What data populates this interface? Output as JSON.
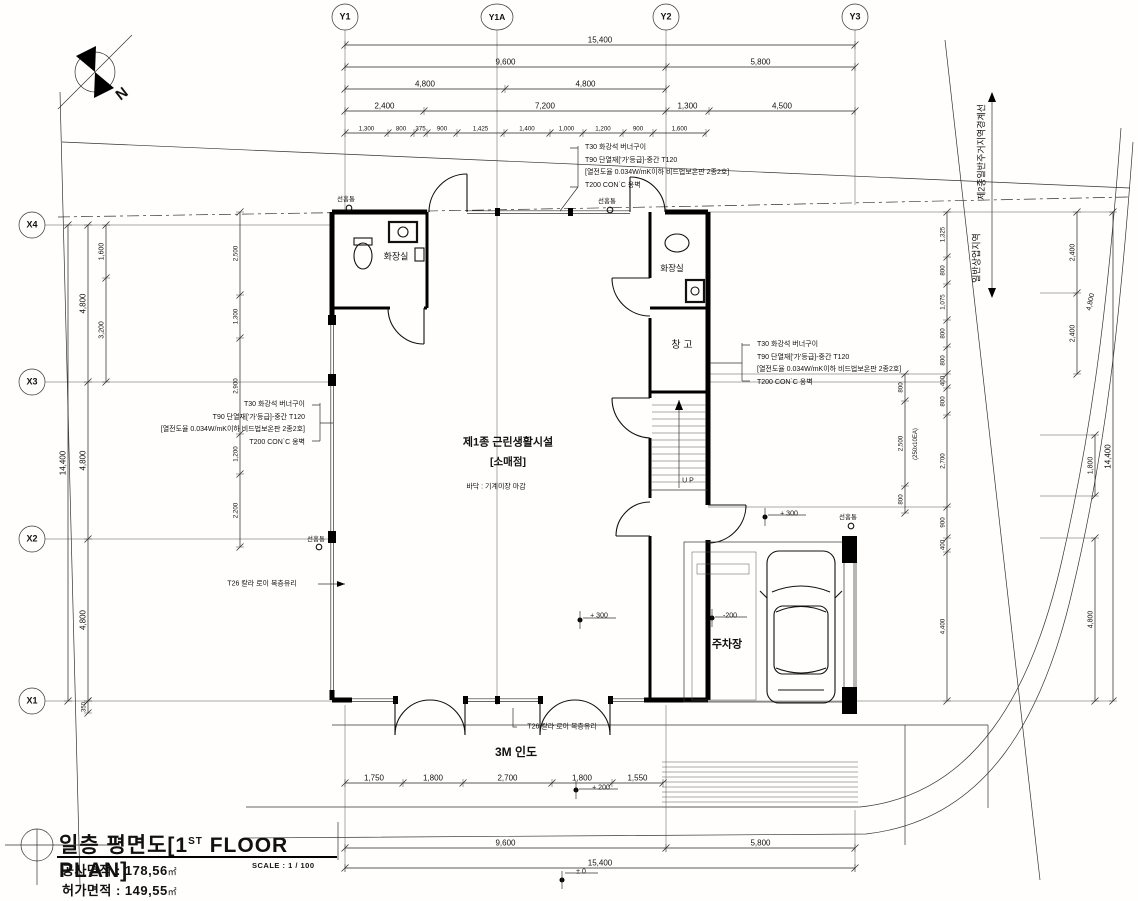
{
  "title_block": {
    "title": "일층 평면도[1",
    "title_sup": "ST",
    "title_tail": " FLOOR PLAN]",
    "area1_label": "공사면적 :",
    "area1_value": "178,56",
    "area1_unit": "㎡",
    "area2_label": "허가면적 :",
    "area2_value": "149,55",
    "area2_unit": "㎡",
    "scale": "SCALE : 1 / 100"
  },
  "notes": {
    "finish_lines": [
      "T30 화강석 버너구이",
      "T90 단열재['가'등급]-중간 T120",
      "[열전도율 0.034W/mK이하 비드법보온판 2종2호]",
      "T200 CON`C 옹벽"
    ],
    "glass_note": "T26 칼라 로이 복층유리",
    "downspout": "선홈통"
  },
  "grid": {
    "y_axes": [
      "Y1",
      "Y1A",
      "Y2",
      "Y3"
    ],
    "x_axes": [
      "X4",
      "X3",
      "X2",
      "X1"
    ]
  },
  "rooms": {
    "main_use": "제1종 근린생활시설",
    "main_use_sub": "[소매점]",
    "floor_finish": "바닥 : 기계미장 마감",
    "restroom": "화장실",
    "storage": "창 고",
    "parking": "주차장",
    "sidewalk": "3M 인도",
    "stair_up": "U P"
  },
  "zones": {
    "boundary": "제2종일반주거지역경계선",
    "commercial": "일반상업지역"
  },
  "levels": [
    "+ 300",
    "+ 300",
    "-200",
    "+ 200",
    "± 0"
  ],
  "dim_chains": [
    {
      "n": "dim-top-row1",
      "o": "h",
      "p": 45,
      "b": [
        345,
        855
      ],
      "v": [
        "15,400"
      ],
      "fs": 8
    },
    {
      "n": "dim-top-row2",
      "o": "h",
      "p": 67,
      "b": [
        345,
        666,
        855
      ],
      "v": [
        "9,600",
        "5,800"
      ],
      "fs": 8
    },
    {
      "n": "dim-top-row3",
      "o": "h",
      "p": 89,
      "b": [
        345,
        505,
        666
      ],
      "v": [
        "4,800",
        "4,800"
      ],
      "fs": 8
    },
    {
      "n": "dim-top-row4",
      "o": "h",
      "p": 111,
      "b": [
        345,
        424,
        666,
        709,
        855
      ],
      "v": [
        "2,400",
        "7,200",
        "1,300",
        "4,500"
      ],
      "fs": 8
    },
    {
      "n": "dim-top-row5",
      "o": "h",
      "p": 133,
      "b": [
        345,
        388,
        414,
        427,
        457,
        504,
        550,
        583,
        623,
        653,
        706
      ],
      "v": [
        "1,300",
        "800",
        "375",
        "900",
        "1,425",
        "1,400",
        "1,000",
        "1,200",
        "900",
        "1,600"
      ],
      "fs": 6.2
    },
    {
      "n": "dim-bottom-row1",
      "o": "h",
      "p": 783,
      "b": [
        345,
        403,
        463,
        552,
        612,
        663
      ],
      "v": [
        "1,750",
        "1,800",
        "2,700",
        "1,800",
        "1,550"
      ],
      "fs": 8
    },
    {
      "n": "dim-bottom-row2",
      "o": "h",
      "p": 848,
      "b": [
        345,
        666,
        855
      ],
      "v": [
        "9,600",
        "5,800"
      ],
      "fs": 8
    },
    {
      "n": "dim-bottom-row3",
      "o": "h",
      "p": 868,
      "b": [
        345,
        855
      ],
      "v": [
        "15,400"
      ],
      "fs": 8
    },
    {
      "n": "dim-left-total",
      "o": "v",
      "p": 68,
      "b": [
        225,
        701
      ],
      "v": [
        "14,400"
      ],
      "fs": 8
    },
    {
      "n": "dim-left-grid",
      "o": "v",
      "p": 88,
      "b": [
        225,
        382,
        539,
        701
      ],
      "v": [
        "4,800",
        "4,800",
        "4,800"
      ],
      "fs": 8
    },
    {
      "n": "dim-left-sub",
      "o": "v",
      "p": 106,
      "b": [
        225,
        278,
        382
      ],
      "v": [
        "1,600",
        "3,200"
      ],
      "fs": 7
    },
    {
      "n": "dim-left-350",
      "o": "v",
      "p": 88,
      "b": [
        701,
        713
      ],
      "v": [
        "350"
      ],
      "fs": 6
    },
    {
      "n": "dim-left-inner",
      "o": "v",
      "p": 240,
      "b": [
        212,
        295,
        338,
        434,
        474,
        547
      ],
      "v": [
        "2,500",
        "1,300",
        "2,900",
        "1,200",
        "2,200"
      ],
      "fs": 6.2
    },
    {
      "n": "dim-right-inner",
      "o": "v",
      "p": 947,
      "b": [
        212,
        257,
        284,
        320,
        347,
        374,
        388,
        415,
        507,
        538,
        552,
        701
      ],
      "v": [
        "1,325",
        "800",
        "1,075",
        "800",
        "800",
        "400",
        "800",
        "2,700",
        "900",
        "400",
        "4,400"
      ],
      "fs": 6.2
    },
    {
      "n": "dim-right-stair",
      "o": "v",
      "p": 905,
      "b": [
        374,
        401,
        486,
        513
      ],
      "v": [
        "800",
        "2,500",
        "800"
      ],
      "fs": 6.2
    },
    {
      "n": "dim-right-2400",
      "o": "v",
      "p": 1077,
      "b": [
        212,
        293,
        374
      ],
      "v": [
        "2,400",
        "2,400"
      ],
      "fs": 7
    },
    {
      "n": "dim-right-1800",
      "o": "v",
      "p": 1095,
      "b": [
        435,
        496
      ],
      "v": [
        "1,800"
      ],
      "fs": 7
    },
    {
      "n": "dim-right-4800",
      "o": "v",
      "p": 1095,
      "b": [
        538,
        701
      ],
      "v": [
        "4,800"
      ],
      "fs": 7
    },
    {
      "n": "dim-right-total",
      "o": "v",
      "p": 1113,
      "b": [
        212,
        701
      ],
      "v": [
        "14,400"
      ],
      "fs": 8
    }
  ],
  "labels": [
    {
      "n": "grid-label-y1",
      "t": "Y1",
      "x": 345,
      "y": 17,
      "fs": 9,
      "w": 600
    },
    {
      "n": "grid-label-y1a",
      "t": "Y1A",
      "x": 497,
      "y": 17,
      "fs": 8.5,
      "w": 600
    },
    {
      "n": "grid-label-y2",
      "t": "Y2",
      "x": 666,
      "y": 17,
      "fs": 9,
      "w": 600
    },
    {
      "n": "grid-label-y3",
      "t": "Y3",
      "x": 855,
      "y": 17,
      "fs": 9,
      "w": 600
    },
    {
      "n": "grid-label-x4",
      "t": "X4",
      "x": 32,
      "y": 225,
      "fs": 9,
      "w": 600
    },
    {
      "n": "grid-label-x3",
      "t": "X3",
      "x": 32,
      "y": 382,
      "fs": 9,
      "w": 600
    },
    {
      "n": "grid-label-x2",
      "t": "X2",
      "x": 32,
      "y": 539,
      "fs": 9,
      "w": 600
    },
    {
      "n": "grid-label-x1",
      "t": "X1",
      "x": 32,
      "y": 701,
      "fs": 9,
      "w": 600
    },
    {
      "n": "room-restroom-left",
      "t": "화장실",
      "x": 396,
      "y": 257,
      "fs": 9
    },
    {
      "n": "room-restroom-right",
      "t": "화장실",
      "x": 672,
      "y": 268,
      "fs": 8.5
    },
    {
      "n": "room-storage",
      "t": "창 고",
      "x": 682,
      "y": 346,
      "fs": 10
    },
    {
      "n": "room-main-use",
      "t": "제1종 근린생활시설",
      "x": 508,
      "y": 443,
      "fs": 11,
      "w": 600
    },
    {
      "n": "room-main-use-sub",
      "t": "[소매점]",
      "x": 508,
      "y": 462,
      "fs": 10.5,
      "w": 600
    },
    {
      "n": "room-floor-finish",
      "t": "바닥 : 기계미장 마감",
      "x": 496,
      "y": 487,
      "fs": 7
    },
    {
      "n": "room-parking",
      "t": "주차장",
      "x": 727,
      "y": 645,
      "fs": 11,
      "w": 700
    },
    {
      "n": "sidewalk-label",
      "t": "3M 인도",
      "x": 516,
      "y": 752,
      "fs": 12,
      "w": 700
    },
    {
      "n": "stair-up-label",
      "t": "U P",
      "x": 688,
      "y": 481,
      "fs": 7
    },
    {
      "n": "zone-boundary-label",
      "t": "제2종일반주거지역경계선",
      "x": 982,
      "y": 152,
      "r": -90,
      "fs": 9
    },
    {
      "n": "zone-commercial-label",
      "t": "일반상업지역",
      "x": 977,
      "y": 258,
      "r": -90,
      "fs": 9
    },
    {
      "n": "downspout-label-1",
      "t": "선홈통",
      "x": 346,
      "y": 200,
      "fs": 6.5
    },
    {
      "n": "downspout-label-2",
      "t": "선홈통",
      "x": 607,
      "y": 202,
      "fs": 6.5
    },
    {
      "n": "downspout-label-3",
      "t": "선홈통",
      "x": 316,
      "y": 540,
      "fs": 6.5
    },
    {
      "n": "downspout-label-4",
      "t": "선홈통",
      "x": 848,
      "y": 518,
      "fs": 6.5
    },
    {
      "n": "glass-note-left",
      "t": "T26 칼라 로이 복층유리",
      "x": 262,
      "y": 584,
      "fs": 7
    },
    {
      "n": "glass-note-bottom",
      "t": "T26 칼라 로이 복층유리",
      "x": 562,
      "y": 727,
      "fs": 7
    },
    {
      "n": "level-plus300-hall",
      "t": "+ 300",
      "x": 599,
      "y": 616,
      "fs": 7
    },
    {
      "n": "level-plus300-parking",
      "t": "+ 300",
      "x": 789,
      "y": 514,
      "fs": 7
    },
    {
      "n": "level-minus200-parking",
      "t": "-200",
      "x": 730,
      "y": 616,
      "fs": 7
    },
    {
      "n": "level-plus200-sidewalk",
      "t": "+ 200",
      "x": 601,
      "y": 788,
      "fs": 7
    },
    {
      "n": "level-zero-bottom",
      "t": "± 0",
      "x": 581,
      "y": 872,
      "fs": 7
    },
    {
      "n": "dim-slant-4800",
      "t": "4,800",
      "x": 1091,
      "y": 302,
      "r": -78,
      "fs": 7
    },
    {
      "n": "stair-riser-note",
      "t": "(250x10EA)",
      "x": 916,
      "y": 444,
      "r": -90,
      "fs": 6
    },
    {
      "n": "compass-north-letter",
      "t": "N",
      "x": 122,
      "y": 94,
      "r": -38,
      "fs": 15,
      "w": 700
    }
  ]
}
